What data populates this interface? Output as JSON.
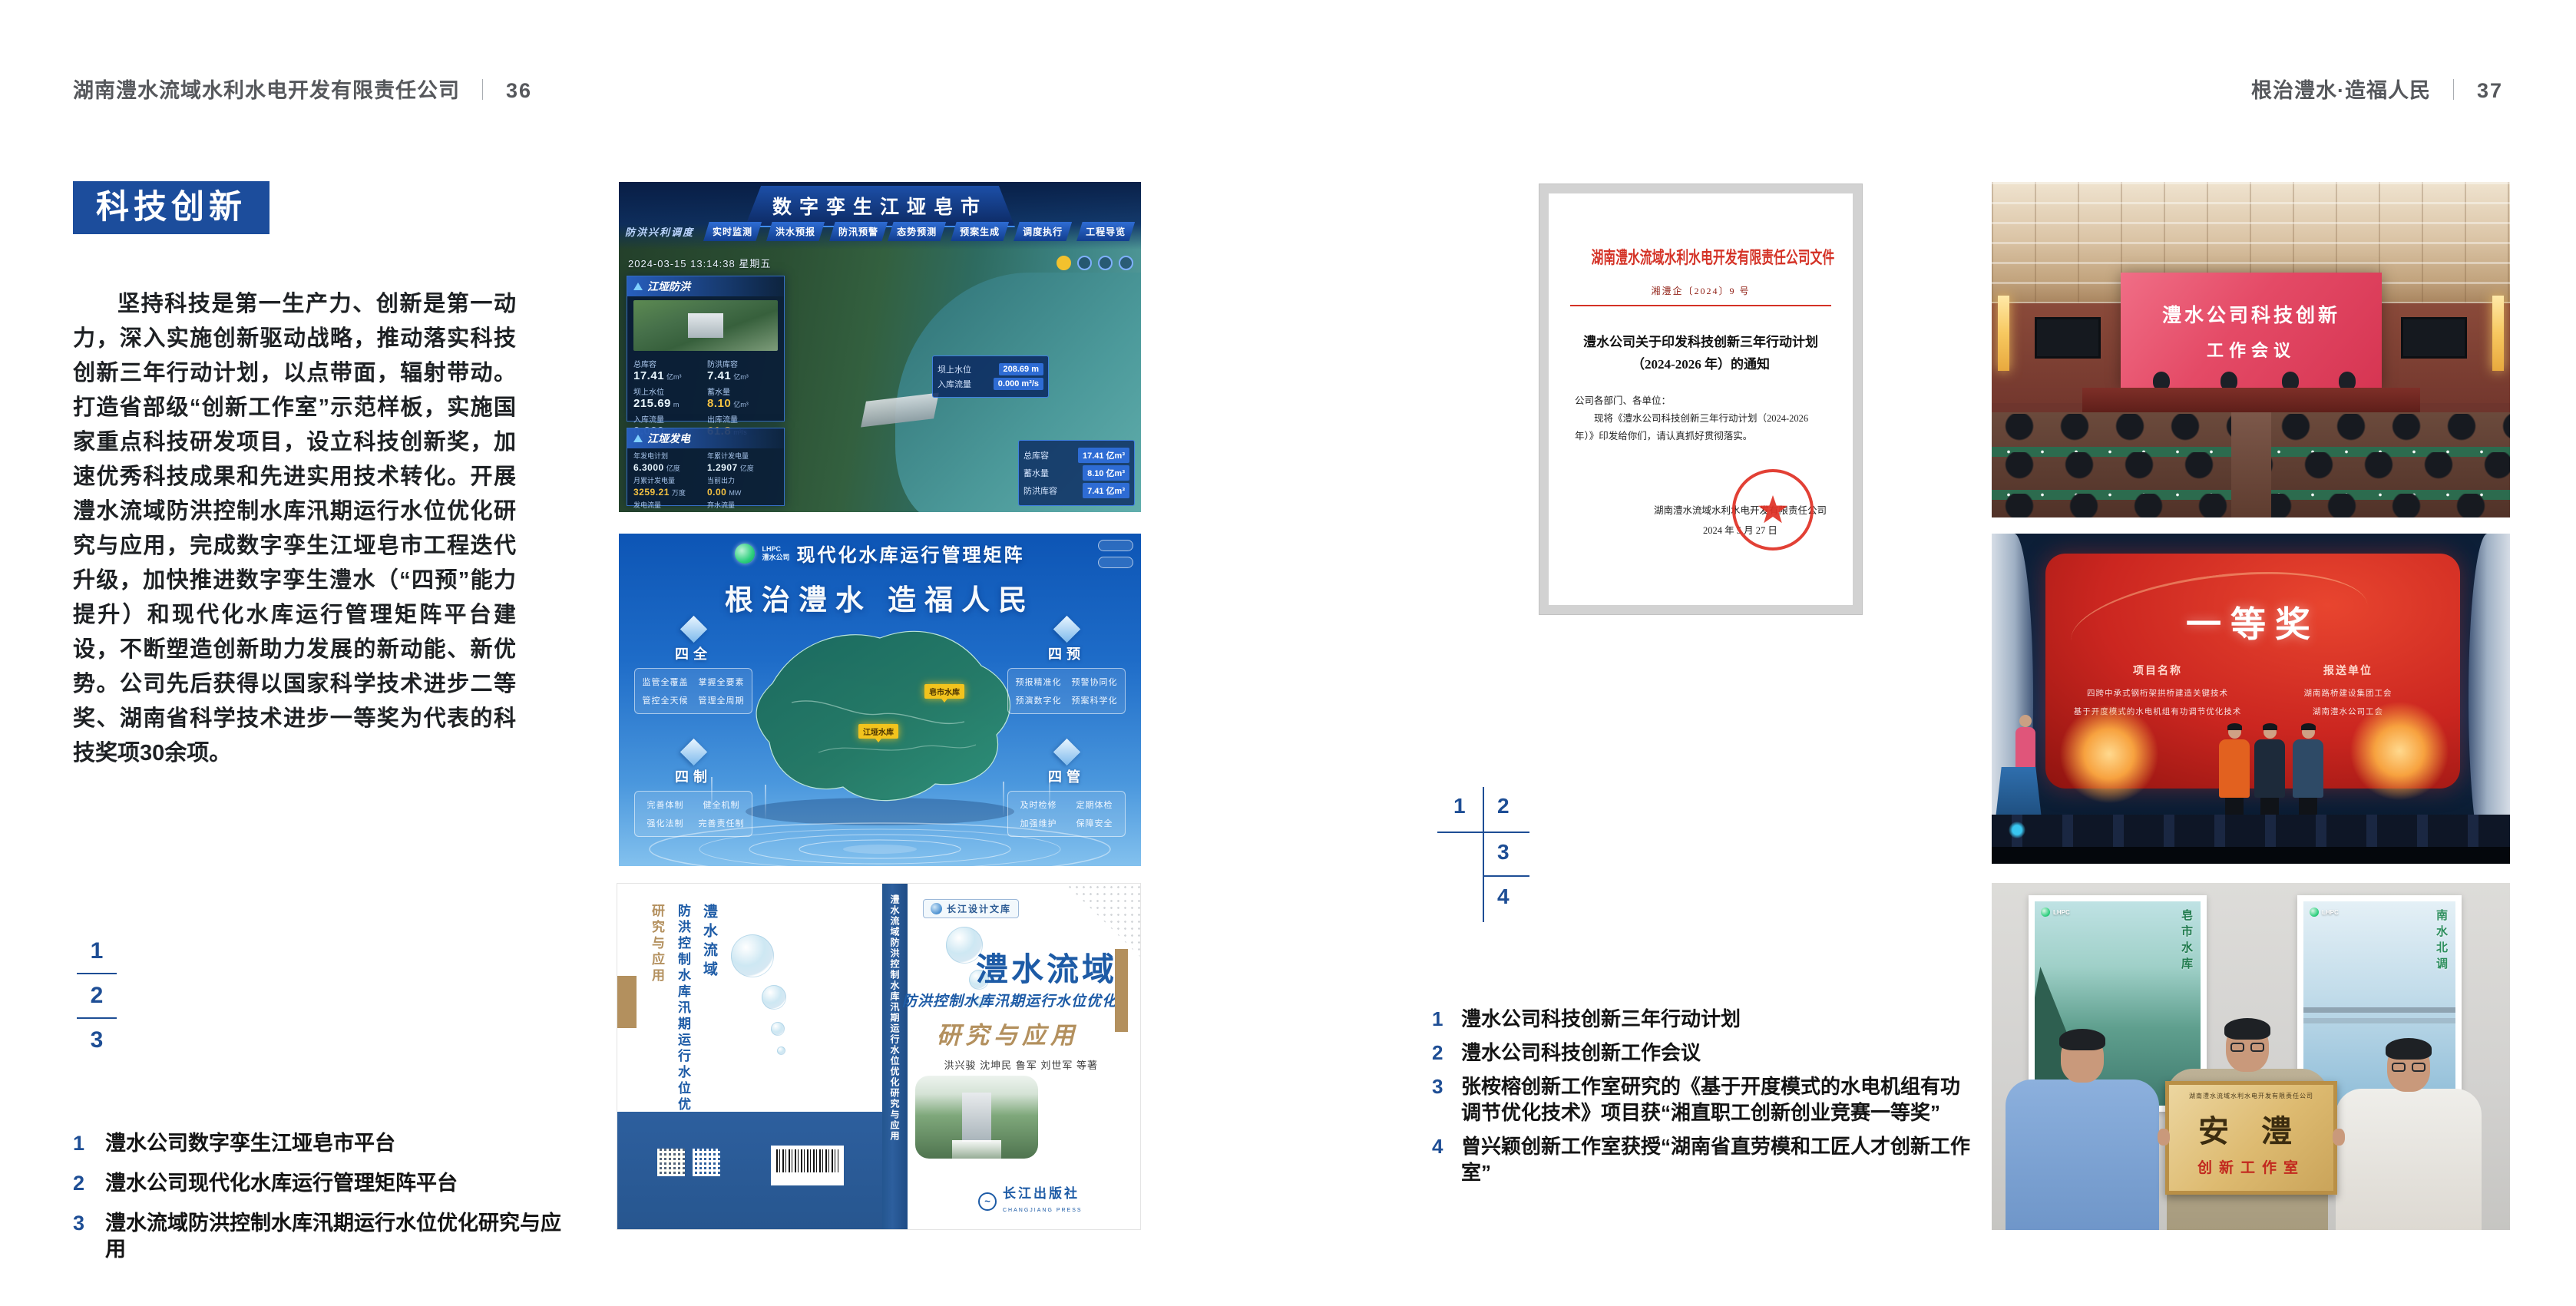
{
  "colors": {
    "accent_blue": "#1c4d9c",
    "marker_blue": "#1e4e95",
    "doc_red": "#d43226",
    "tan": "#b3905e"
  },
  "header": {
    "left_title": "湖南澧水流域水利水电开发有限责任公司",
    "left_page": "36",
    "right_title": "根治澧水·造福人民",
    "right_page": "37",
    "divider": "｜"
  },
  "left_page": {
    "section_badge": "科技创新",
    "paragraph": "坚持科技是第一生产力、创新是第一动力，深入实施创新驱动战略，推动落实科技创新三年行动计划，以点带面，辐射带动。打造省部级“创新工作室”示范样板，实施国家重点科技研发项目，设立科技创新奖，加速优秀科技成果和先进实用技术转化。开展澧水流域防洪控制水库汛期运行水位优化研究与应用，完成数字孪生江垭皂市工程迭代升级，加快推进数字孪生澧水（“四预”能力提升）和现代化水库运行管理矩阵平台建设，不断塑造创新助力发展的新动能、新优势。公司先后获得以国家科学技术进步二等奖、湖南省科学技术进步一等奖为代表的科技奖项30余项。",
    "figure_markers": [
      "1",
      "2",
      "3"
    ],
    "captions": [
      {
        "num": "1",
        "text": "澧水公司数字孪生江垭皂市平台"
      },
      {
        "num": "2",
        "text": "澧水公司现代化水库运行管理矩阵平台"
      },
      {
        "num": "3",
        "text": "澧水流域防洪控制水库汛期运行水位优化研究与应用"
      }
    ]
  },
  "right_page": {
    "figure_markers": [
      "1",
      "2",
      "3",
      "4"
    ],
    "captions": [
      {
        "num": "1",
        "text": "澧水公司科技创新三年行动计划"
      },
      {
        "num": "2",
        "text": "澧水公司科技创新工作会议"
      },
      {
        "num": "3",
        "text": "张桉榕创新工作室研究的《基于开度模式的水电机组有功调节优化技术》项目获“湘直职工创新创业竞赛一等奖”"
      },
      {
        "num": "4",
        "text": "曾兴颖创新工作室获授“湖南省直劳模和工匠人才创新工作室”"
      }
    ]
  },
  "dashboard": {
    "title": "数字孪生江垭皂市",
    "module_label": "防洪兴利调度",
    "tabs_left": [
      "实时监测",
      "洪水预报",
      "防汛预警"
    ],
    "tabs_right": [
      "态势预测",
      "预案生成",
      "调度执行",
      "工程导览"
    ],
    "timestamp": "2024-03-15 13:14:38 星期五",
    "panel1_title": "江垭防洪",
    "panel1_stats": [
      {
        "label": "总库容",
        "value": "17.41",
        "unit": "亿m³"
      },
      {
        "label": "防洪库容",
        "value": "7.41",
        "unit": "亿m³"
      },
      {
        "label": "坝上水位",
        "value": "215.69",
        "unit": "m"
      },
      {
        "label": "蓄水量",
        "value": "8.10",
        "unit": "亿m³"
      },
      {
        "label": "入库流量",
        "value": "0.000",
        "unit": "m³/s"
      },
      {
        "label": "出库流量",
        "value": "61.8",
        "unit": "m³/s"
      }
    ],
    "panel2_title": "江垭发电",
    "panel2_stats": [
      {
        "label": "年发电计划",
        "value": "6.3000",
        "unit": "亿度"
      },
      {
        "label": "年累计发电量",
        "value": "1.2907",
        "unit": "亿度"
      },
      {
        "label": "月累计发电量",
        "value": "3259.21",
        "unit": "万度"
      },
      {
        "label": "当前出力",
        "value": "0.00",
        "unit": "MW"
      },
      {
        "label": "发电流量",
        "value": "0.00",
        "unit": "m³/s"
      },
      {
        "label": "弃水流量",
        "value": "0.00",
        "unit": "m³/s"
      }
    ],
    "tooltip": [
      {
        "label": "坝上水位",
        "value": "208.69 m"
      },
      {
        "label": "入库流量",
        "value": "0.000 m³/s"
      }
    ],
    "mini_stats": [
      {
        "label": "总库容",
        "value": "17.41 亿m³"
      },
      {
        "label": "蓄水量",
        "value": "8.10 亿m³"
      },
      {
        "label": "防洪库容",
        "value": "7.41 亿m³"
      }
    ]
  },
  "matrix": {
    "logo_text": "LHPC",
    "logo_sub": "澧水公司",
    "title": "现代化水库运行管理矩阵",
    "slogan": "根治澧水 造福人民",
    "panels": [
      {
        "title": "四全",
        "items": [
          "监管全覆盖",
          "掌握全要素",
          "管控全天候",
          "管理全周期"
        ]
      },
      {
        "title": "四预",
        "items": [
          "预报精准化",
          "预警协同化",
          "预演数字化",
          "预案科学化"
        ]
      },
      {
        "title": "四制",
        "items": [
          "完善体制",
          "健全机制",
          "强化法制",
          "完善责任制"
        ]
      },
      {
        "title": "四管",
        "items": [
          "及时检修",
          "定期体检",
          "加强维护",
          "保障安全"
        ]
      }
    ],
    "marker1": "皂市水库",
    "marker2": "江垭水库"
  },
  "book": {
    "series": "长江设计文库",
    "title_main": "澧水流域",
    "title_sub": "防洪控制水库汛期运行水位优化",
    "title_tail": "研究与应用",
    "authors": "洪兴骏 沈坤民 鲁军 刘世军 等著",
    "spine": "澧水流域防洪控制水库汛期运行水位优化研究与应用",
    "publisher": "长江出版社",
    "publisher_en": "CHANGJIANG PRESS"
  },
  "document": {
    "header": "湖南澧水流域水利水电开发有限责任公司文件",
    "doc_no": "湘澧企〔2024〕9 号",
    "title_line1": "澧水公司关于印发科技创新三年行动计划",
    "title_line2": "（2024-2026 年）的通知",
    "salutation": "公司各部门、各单位：",
    "body": "现将《澧水公司科技创新三年行动计划（2024-2026 年）》印发给你们，请认真抓好贯彻落实。",
    "signer": "湖南澧水流域水利水电开发有限责任公司",
    "date": "2024 年 5 月 27 日"
  },
  "meeting": {
    "screen_line1": "澧水公司科技创新",
    "screen_line2": "工作会议"
  },
  "award": {
    "title": "一等奖",
    "col1_header": "项目名称",
    "col2_header": "报送单位",
    "projects": [
      "四跨中承式钢桁架拱桥建造关键技术",
      "基于开度模式的水电机组有功调节优化技术"
    ],
    "units": [
      "湖南路桥建设集团工会",
      "湖南澧水公司工会"
    ]
  },
  "plaque": {
    "poster_logo": "LHPC",
    "poster_left_vertical": "皂市水库",
    "poster_right_vertical": "南水北调",
    "header": "湖南澧水流域水利水电开发有限责任公司",
    "main": "安 澧",
    "sub": "创新工作室"
  }
}
